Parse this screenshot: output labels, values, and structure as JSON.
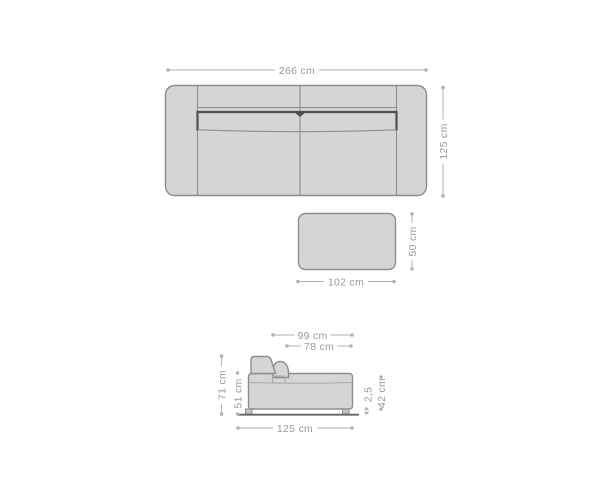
{
  "colors": {
    "background": "#ffffff",
    "sofa_fill": "#d5d5d5",
    "sofa_outline": "#8d8d8d",
    "dark_accent": "#4e4e4e",
    "seam_light": "#a9a9a9",
    "dim_line": "#b2b2b2",
    "dim_text": "#9a9a9a",
    "leg_fill": "#c3c3c3",
    "baseline": "#646464"
  },
  "top_view": {
    "width": "266 cm",
    "depth": "125 cm"
  },
  "ottoman": {
    "width": "102 cm",
    "depth": "50 cm"
  },
  "side_view": {
    "overall_depth": "99 cm",
    "seat_depth": "78 cm",
    "back_height": "71 cm",
    "arm_height": "51 cm",
    "length": "125 cm",
    "leg_height": "2,5",
    "seat_height": "42 cm"
  }
}
